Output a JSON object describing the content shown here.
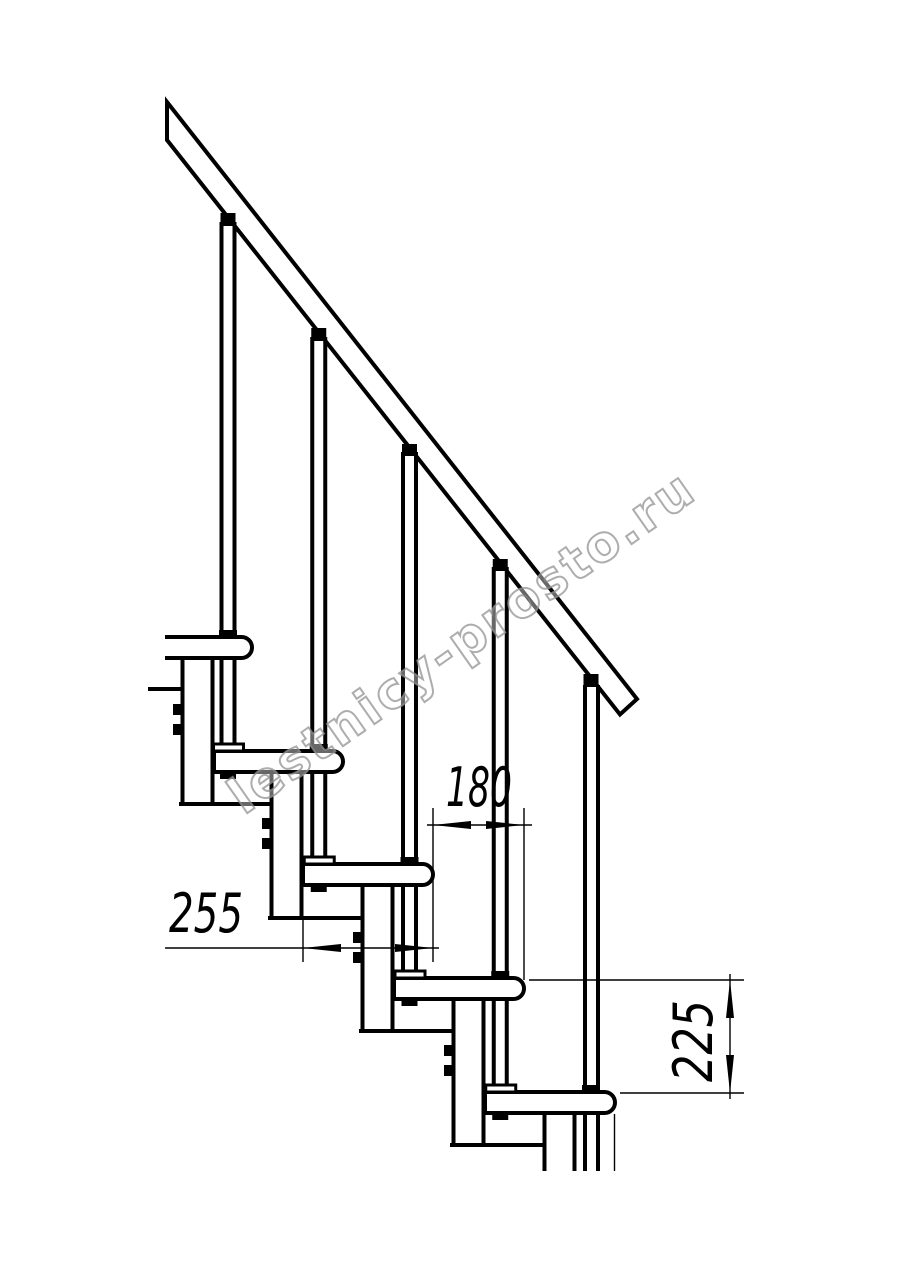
{
  "drawing": {
    "kind": "modular-staircase-side-view",
    "background": "#ffffff",
    "line_color": "#000000",
    "steps_visible": 5,
    "balusters_visible": 5
  },
  "dimensions": {
    "step_overlap": {
      "value": "180",
      "orientation": "horizontal"
    },
    "tread_depth": {
      "value": "255",
      "orientation": "horizontal"
    },
    "riser_height": {
      "value": "225",
      "orientation": "vertical"
    }
  },
  "watermark": {
    "text": "lestnicy-prosto.ru",
    "color": "#949494"
  }
}
